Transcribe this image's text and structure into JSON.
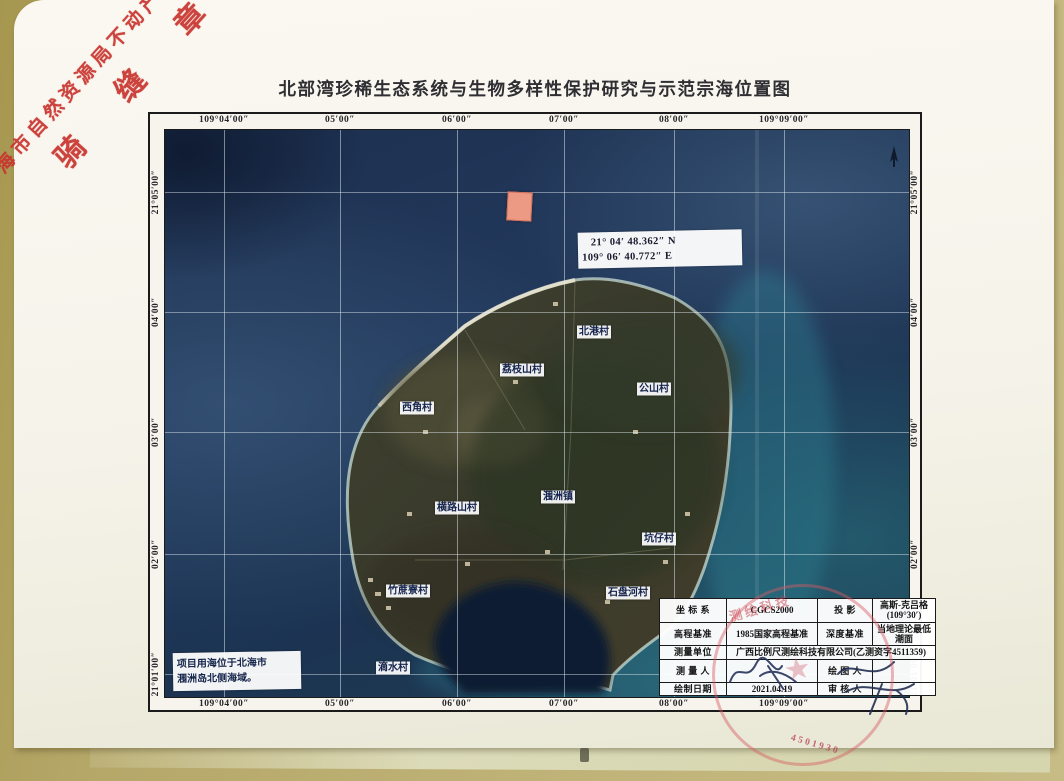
{
  "page": {
    "title": "北部湾珍稀生态系统与生物多样性保护研究与示范宗海位置图"
  },
  "corner_stamp": {
    "line1": "北海市自然资源局不动产登记",
    "line2": "骑 缝 章",
    "color": "#c9332e"
  },
  "map": {
    "top_labels": [
      "109°04′00″",
      "05′00″",
      "06′00″",
      "07′00″",
      "08′00″",
      "109°09′00″"
    ],
    "bottom_labels": [
      "109°04′00″",
      "05′00″",
      "06′00″",
      "07′00″",
      "08′00″",
      "109°09′00″"
    ],
    "left_labels": [
      "21°05′00″",
      "04′00″",
      "03′00″",
      "02′00″",
      "21°01′00″"
    ],
    "right_labels": [
      "21°05′00″",
      "04′00″",
      "03′00″",
      "02′00″",
      "21°01′00″"
    ],
    "marker": {
      "color": "#ec9a84",
      "coord_line1": "21° 04′ 48.362″ N",
      "coord_line2": "109° 06′ 40.772″ E"
    },
    "villages": [
      "北港村",
      "荔枝山村",
      "公山村",
      "西角村",
      "横路山村",
      "涠洲镇",
      "坑仔村",
      "竹蔗寮村",
      "石盘河村",
      "滴水村"
    ],
    "note": {
      "line1": "项目用海位于北海市",
      "line2": "涠洲岛北侧海域。"
    },
    "ocean_color": "#22395c",
    "island_color": "#3b3a2a"
  },
  "info_table": {
    "r1": {
      "k1": "坐 标 系",
      "v1": "CGCS2000",
      "k2": "投  影",
      "v2a": "高斯-克吕格",
      "v2b": "(109°30′)"
    },
    "r2": {
      "k1": "高程基准",
      "v1": "1985国家高程基准",
      "k2": "深度基准",
      "v2": "当地理论最低潮面"
    },
    "r3": {
      "k1": "测量单位",
      "v1": "广西比例尺测绘科技有限公司(乙测资字4511359)"
    },
    "r4": {
      "k1": "测 量 人",
      "k2": "绘 图 人"
    },
    "r5": {
      "k1": "绘制日期",
      "v1": "2021.04.19",
      "k2": "审 核 人"
    }
  },
  "seal": {
    "arc_text": "测绘科技",
    "digits": "4501930"
  }
}
